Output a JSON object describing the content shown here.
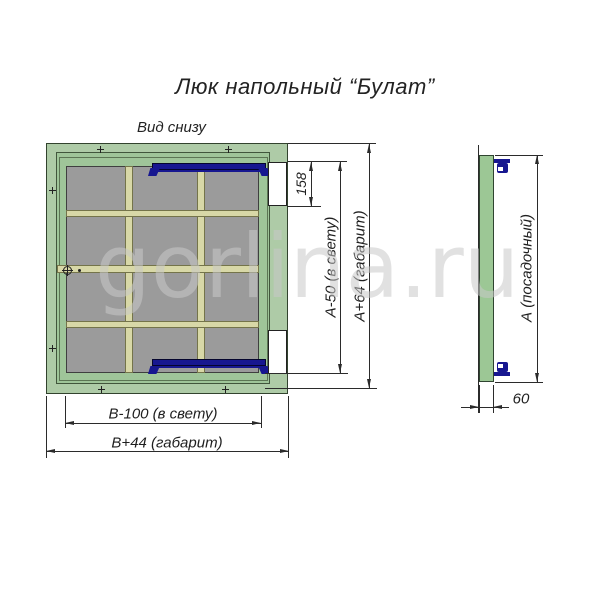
{
  "title": "Люк напольный “Булат”",
  "watermark": "gorlina.ru",
  "bottom_view": {
    "label": "Вид снизу",
    "dims": {
      "hinge_cutout": "158",
      "clear_height": "А-50 (в свету)",
      "overall_height": "А+64 (габарит)",
      "clear_width": "В-100 (в свету)",
      "overall_width": "В+44 (габарит)"
    }
  },
  "side_view": {
    "dims": {
      "seat_height": "А (посадочный)",
      "thickness": "60"
    }
  },
  "colors": {
    "frame_green": "#aecba7",
    "lid_green": "#9fc599",
    "panel_gray": "#9b9b9b",
    "rib_khaki": "#d8d8a7",
    "hinge_navy": "#171790",
    "line_black": "#2b2b2b",
    "watermark_gray": "#c8c8c8"
  }
}
